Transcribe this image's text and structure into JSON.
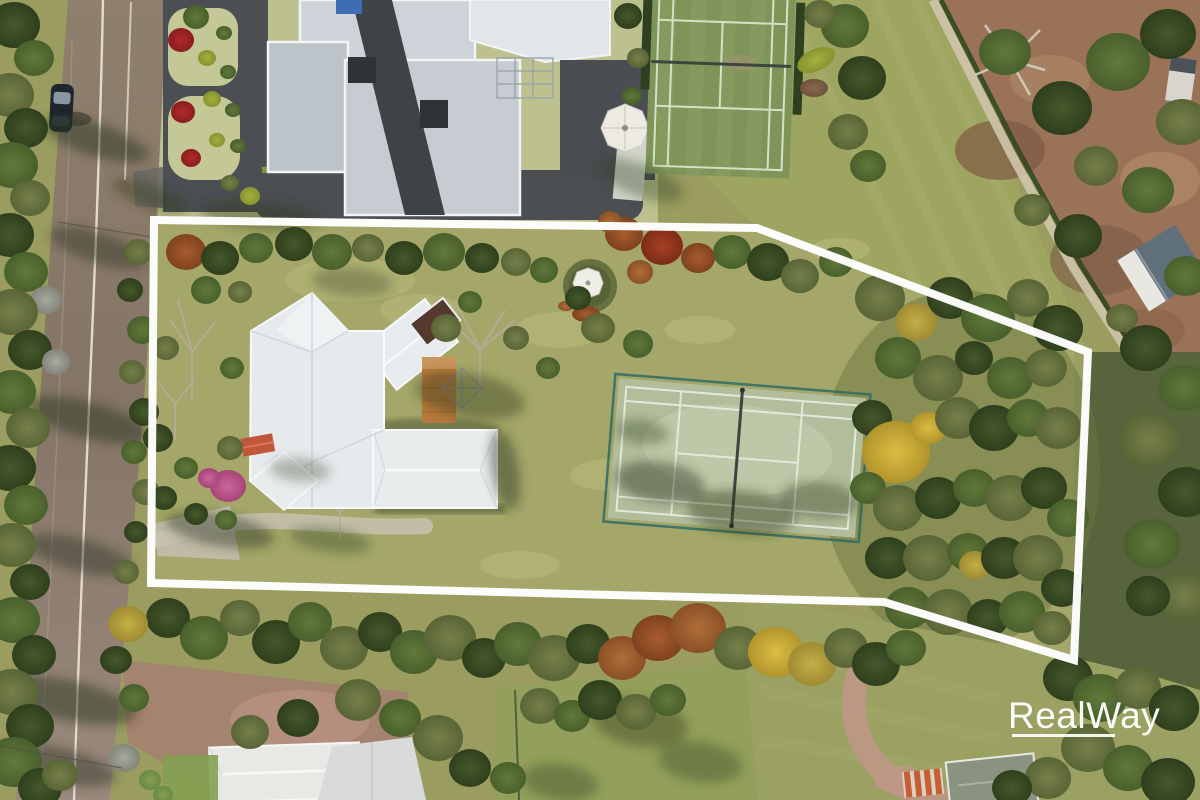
{
  "meta": {
    "kind": "aerial-drone-photo",
    "subject": "rural residential property with white boundary outline overlay"
  },
  "watermark": {
    "brand": "RealWay",
    "underline": true
  },
  "palette": {
    "base": "#9a9c60",
    "white": "#ffffff",
    "interior": "#a6a96b",
    "road1": "#8f7f6c",
    "road2": "#857567",
    "road3": "#9a897c",
    "roadLine": "#eae6da",
    "asphalt": "#4b4f53",
    "mansionLawn": "#bcc18f",
    "roofLight": "#cdd3d8",
    "roofMid": "#bcc3c9",
    "roofWhite": "#e2e6e9",
    "roofDark": "#3f4347",
    "houseRoof": "#e6eaec",
    "deck": "#b5793c",
    "awning": "#c0563a",
    "darkRoof": "#56392e",
    "topCourt": "#7e9459",
    "topCourtLine": "#d7e0c4",
    "paddock": "#9ea560",
    "dirt": "#997257",
    "track": "#cfc5ad",
    "hedgeLine": "#33471f",
    "court": "#b2bd9c",
    "courtLight": "#c3ccad",
    "courtLine": "#e3e9d9",
    "net": "#3c463e",
    "fence": "#2e6b66",
    "gazeboRoof": "#efeee7",
    "gazeboHedge": "#66713f",
    "field": "#9aa162",
    "lawn2": "#93a05b",
    "gravel": "#a4836f",
    "pinkPath": "#c09688",
    "sail": "#d8dbda",
    "roofBL": "#e8e9e5",
    "houseBR": "#8a9282",
    "shedOrange": "#c65f33",
    "barn": "#60707a",
    "shadow": "#2c381f"
  },
  "boundary": {
    "points": [
      [
        154,
        220
      ],
      [
        757,
        228
      ],
      [
        1088,
        352
      ],
      [
        1074,
        660
      ],
      [
        884,
        602
      ],
      [
        151,
        583
      ]
    ],
    "stroke_width": 8
  },
  "scene": {
    "regions": [
      "street",
      "neighbour-mansion",
      "neighbour-tennis-court",
      "paddock",
      "bare-dirt-yard",
      "property-lawn",
      "main-house",
      "timber-deck",
      "garden-gazebo",
      "private-tennis-court",
      "woodland",
      "rear-lawn",
      "neighbour-house-south",
      "gravel-driveway"
    ],
    "trees": [
      [
        14,
        25,
        26,
        "dg"
      ],
      [
        34,
        58,
        20,
        "mg"
      ],
      [
        10,
        95,
        24,
        "og"
      ],
      [
        26,
        128,
        22,
        "dg"
      ],
      [
        12,
        165,
        26,
        "mg"
      ],
      [
        30,
        198,
        20,
        "og"
      ],
      [
        10,
        235,
        24,
        "dg"
      ],
      [
        26,
        272,
        22,
        "mg"
      ],
      [
        46,
        300,
        16,
        "gray"
      ],
      [
        12,
        312,
        26,
        "og"
      ],
      [
        30,
        350,
        22,
        "dg"
      ],
      [
        56,
        362,
        14,
        "gray"
      ],
      [
        12,
        392,
        24,
        "mg"
      ],
      [
        28,
        428,
        22,
        "og"
      ],
      [
        10,
        468,
        26,
        "dg"
      ],
      [
        26,
        505,
        22,
        "mg"
      ],
      [
        12,
        545,
        24,
        "og"
      ],
      [
        30,
        582,
        20,
        "dg"
      ],
      [
        14,
        620,
        26,
        "mg"
      ],
      [
        34,
        655,
        22,
        "dg"
      ],
      [
        12,
        692,
        26,
        "og"
      ],
      [
        30,
        726,
        24,
        "dg"
      ],
      [
        14,
        762,
        28,
        "mg"
      ],
      [
        40,
        788,
        22,
        "dg"
      ],
      [
        60,
        775,
        18,
        "og"
      ],
      [
        138,
        252,
        14,
        "og"
      ],
      [
        130,
        290,
        13,
        "dg"
      ],
      [
        142,
        330,
        15,
        "mg"
      ],
      [
        132,
        372,
        13,
        "og"
      ],
      [
        144,
        412,
        15,
        "dg"
      ],
      [
        134,
        452,
        13,
        "mg"
      ],
      [
        146,
        492,
        14,
        "og"
      ],
      [
        136,
        532,
        12,
        "dg"
      ],
      [
        126,
        572,
        13,
        "og"
      ],
      [
        181,
        40,
        13,
        "red"
      ],
      [
        183,
        112,
        12,
        "red"
      ],
      [
        191,
        158,
        10,
        "red"
      ],
      [
        196,
        17,
        13,
        "mg"
      ],
      [
        207,
        58,
        9,
        "ch"
      ],
      [
        212,
        99,
        9,
        "ch"
      ],
      [
        217,
        140,
        8,
        "ch"
      ],
      [
        224,
        33,
        8,
        "mg"
      ],
      [
        228,
        72,
        8,
        "mg"
      ],
      [
        233,
        110,
        8,
        "mg"
      ],
      [
        238,
        146,
        8,
        "mg"
      ],
      [
        230,
        183,
        9,
        "og"
      ],
      [
        250,
        196,
        10,
        "ch"
      ],
      [
        628,
        16,
        14,
        "dg"
      ],
      [
        638,
        58,
        11,
        "og"
      ],
      [
        632,
        96,
        10,
        "mg"
      ],
      [
        845,
        26,
        24,
        "mg"
      ],
      [
        862,
        78,
        24,
        "dg"
      ],
      [
        848,
        132,
        20,
        "og"
      ],
      [
        868,
        166,
        18,
        "mg"
      ],
      [
        820,
        14,
        16,
        "og"
      ],
      [
        1005,
        52,
        26,
        "mg"
      ],
      [
        1062,
        108,
        30,
        "dg"
      ],
      [
        1118,
        62,
        32,
        "mg"
      ],
      [
        1168,
        34,
        28,
        "dg"
      ],
      [
        1182,
        122,
        26,
        "og"
      ],
      [
        1148,
        190,
        26,
        "mg"
      ],
      [
        1096,
        166,
        22,
        "og"
      ],
      [
        1078,
        236,
        24,
        "dg"
      ],
      [
        1186,
        276,
        22,
        "mg"
      ],
      [
        1032,
        210,
        18,
        "og"
      ],
      [
        1122,
        318,
        16,
        "og"
      ],
      [
        1146,
        348,
        26,
        "dg"
      ],
      [
        1184,
        388,
        26,
        "mg"
      ],
      [
        1150,
        440,
        30,
        "og"
      ],
      [
        1186,
        492,
        28,
        "dg"
      ],
      [
        1152,
        544,
        28,
        "mg"
      ],
      [
        1184,
        596,
        26,
        "og"
      ],
      [
        1148,
        596,
        22,
        "dg"
      ],
      [
        186,
        252,
        20,
        "rust"
      ],
      [
        220,
        258,
        19,
        "dg"
      ],
      [
        256,
        248,
        17,
        "mg"
      ],
      [
        294,
        244,
        19,
        "dg"
      ],
      [
        332,
        252,
        20,
        "mg"
      ],
      [
        368,
        248,
        16,
        "og"
      ],
      [
        404,
        258,
        19,
        "dg"
      ],
      [
        444,
        252,
        21,
        "mg"
      ],
      [
        482,
        258,
        17,
        "dg"
      ],
      [
        516,
        262,
        15,
        "og"
      ],
      [
        544,
        270,
        14,
        "mg"
      ],
      [
        206,
        290,
        15,
        "mg"
      ],
      [
        240,
        292,
        12,
        "og"
      ],
      [
        624,
        234,
        19,
        "rust"
      ],
      [
        662,
        246,
        21,
        "red2"
      ],
      [
        698,
        258,
        17,
        "rust"
      ],
      [
        640,
        272,
        13,
        "copper"
      ],
      [
        610,
        222,
        12,
        "copper"
      ],
      [
        732,
        252,
        19,
        "mg"
      ],
      [
        768,
        262,
        21,
        "dg"
      ],
      [
        800,
        276,
        19,
        "og"
      ],
      [
        836,
        262,
        17,
        "mg"
      ],
      [
        166,
        348,
        13,
        "og"
      ],
      [
        232,
        368,
        12,
        "mg"
      ],
      [
        158,
        438,
        15,
        "dg"
      ],
      [
        230,
        448,
        13,
        "og"
      ],
      [
        186,
        468,
        12,
        "mg"
      ],
      [
        164,
        498,
        13,
        "dg"
      ],
      [
        196,
        514,
        12,
        "dg"
      ],
      [
        226,
        520,
        11,
        "mg"
      ],
      [
        228,
        486,
        18,
        "pink"
      ],
      [
        209,
        478,
        11,
        "pink"
      ],
      [
        446,
        328,
        15,
        "og"
      ],
      [
        516,
        338,
        13,
        "og"
      ],
      [
        548,
        368,
        12,
        "mg"
      ],
      [
        598,
        328,
        17,
        "og"
      ],
      [
        638,
        344,
        15,
        "mg"
      ],
      [
        578,
        298,
        13,
        "dg"
      ],
      [
        470,
        302,
        12,
        "mg"
      ],
      [
        880,
        298,
        25,
        "og"
      ],
      [
        916,
        322,
        21,
        "gold2"
      ],
      [
        950,
        298,
        23,
        "dg"
      ],
      [
        988,
        318,
        27,
        "mg"
      ],
      [
        1028,
        298,
        21,
        "og"
      ],
      [
        1058,
        328,
        25,
        "dg"
      ],
      [
        898,
        358,
        23,
        "mg"
      ],
      [
        938,
        378,
        25,
        "og"
      ],
      [
        974,
        358,
        19,
        "dg"
      ],
      [
        1010,
        378,
        23,
        "mg"
      ],
      [
        1046,
        368,
        21,
        "og"
      ],
      [
        872,
        418,
        20,
        "dg"
      ],
      [
        896,
        452,
        34,
        "gold"
      ],
      [
        928,
        428,
        18,
        "gold"
      ],
      [
        958,
        418,
        23,
        "og"
      ],
      [
        994,
        428,
        25,
        "dg"
      ],
      [
        1028,
        418,
        21,
        "mg"
      ],
      [
        1058,
        428,
        23,
        "og"
      ],
      [
        868,
        488,
        18,
        "mg"
      ],
      [
        898,
        508,
        25,
        "og"
      ],
      [
        938,
        498,
        23,
        "dg"
      ],
      [
        974,
        488,
        21,
        "mg"
      ],
      [
        1010,
        498,
        25,
        "og"
      ],
      [
        1044,
        488,
        23,
        "dg"
      ],
      [
        1068,
        518,
        21,
        "mg"
      ],
      [
        888,
        558,
        23,
        "dg"
      ],
      [
        928,
        558,
        25,
        "og"
      ],
      [
        968,
        552,
        21,
        "mg"
      ],
      [
        975,
        565,
        16,
        "gold2"
      ],
      [
        1004,
        558,
        23,
        "dg"
      ],
      [
        1038,
        558,
        25,
        "og"
      ],
      [
        1062,
        588,
        21,
        "dg"
      ],
      [
        908,
        608,
        23,
        "mg"
      ],
      [
        948,
        612,
        25,
        "og"
      ],
      [
        988,
        618,
        21,
        "dg"
      ],
      [
        1022,
        612,
        23,
        "mg"
      ],
      [
        1052,
        628,
        19,
        "og"
      ],
      [
        168,
        618,
        22,
        "dg"
      ],
      [
        204,
        638,
        24,
        "mg"
      ],
      [
        240,
        618,
        20,
        "og"
      ],
      [
        276,
        642,
        24,
        "dg"
      ],
      [
        310,
        622,
        22,
        "mg"
      ],
      [
        344,
        648,
        24,
        "og"
      ],
      [
        380,
        632,
        22,
        "dg"
      ],
      [
        414,
        652,
        24,
        "mg"
      ],
      [
        450,
        638,
        26,
        "og"
      ],
      [
        484,
        658,
        22,
        "dg"
      ],
      [
        518,
        644,
        24,
        "mg"
      ],
      [
        554,
        658,
        26,
        "og"
      ],
      [
        588,
        644,
        22,
        "dg"
      ],
      [
        622,
        658,
        24,
        "copper"
      ],
      [
        658,
        638,
        26,
        "rust"
      ],
      [
        698,
        628,
        28,
        "copper"
      ],
      [
        738,
        648,
        24,
        "og"
      ],
      [
        776,
        652,
        28,
        "gold"
      ],
      [
        812,
        664,
        24,
        "gold2"
      ],
      [
        846,
        648,
        22,
        "og"
      ],
      [
        876,
        664,
        24,
        "dg"
      ],
      [
        906,
        648,
        20,
        "mg"
      ],
      [
        128,
        624,
        20,
        "gold2"
      ],
      [
        116,
        660,
        16,
        "dg"
      ],
      [
        134,
        698,
        15,
        "mg"
      ],
      [
        124,
        758,
        16,
        "gray"
      ],
      [
        150,
        780,
        11,
        "bg"
      ],
      [
        163,
        795,
        10,
        "bg"
      ],
      [
        250,
        732,
        19,
        "og"
      ],
      [
        298,
        718,
        21,
        "dg"
      ],
      [
        358,
        700,
        23,
        "og"
      ],
      [
        400,
        718,
        21,
        "mg"
      ],
      [
        438,
        738,
        25,
        "og"
      ],
      [
        470,
        768,
        21,
        "dg"
      ],
      [
        508,
        778,
        18,
        "mg"
      ],
      [
        540,
        706,
        20,
        "og"
      ],
      [
        572,
        716,
        18,
        "mg"
      ],
      [
        600,
        700,
        22,
        "dg"
      ],
      [
        636,
        712,
        20,
        "og"
      ],
      [
        668,
        700,
        18,
        "mg"
      ],
      [
        1068,
        678,
        25,
        "dg"
      ],
      [
        1100,
        698,
        27,
        "mg"
      ],
      [
        1138,
        688,
        23,
        "og"
      ],
      [
        1174,
        708,
        25,
        "dg"
      ],
      [
        1088,
        748,
        27,
        "og"
      ],
      [
        1128,
        768,
        25,
        "mg"
      ],
      [
        1168,
        782,
        27,
        "dg"
      ],
      [
        1048,
        778,
        23,
        "og"
      ],
      [
        1012,
        788,
        20,
        "dg"
      ]
    ],
    "shadows": [
      [
        96,
        140,
        55,
        16,
        18,
        0.5
      ],
      [
        98,
        248,
        50,
        15,
        18,
        0.45
      ],
      [
        88,
        420,
        62,
        18,
        15,
        0.5
      ],
      [
        80,
        555,
        55,
        16,
        15,
        0.45
      ],
      [
        66,
        700,
        72,
        20,
        12,
        0.5
      ],
      [
        55,
        765,
        62,
        18,
        12,
        0.45
      ],
      [
        150,
        196,
        40,
        12,
        20,
        0.4
      ],
      [
        660,
        482,
        45,
        20,
        8,
        0.45
      ],
      [
        742,
        512,
        55,
        22,
        6,
        0.42
      ],
      [
        820,
        500,
        40,
        18,
        6,
        0.38
      ],
      [
        642,
        432,
        26,
        12,
        8,
        0.35
      ],
      [
        640,
        722,
        48,
        24,
        10,
        0.4
      ],
      [
        700,
        762,
        42,
        20,
        8,
        0.35
      ],
      [
        560,
        782,
        38,
        18,
        8,
        0.35
      ],
      [
        470,
        396,
        55,
        22,
        10,
        0.4
      ],
      [
        352,
        282,
        40,
        14,
        5,
        0.3
      ],
      [
        300,
        470,
        30,
        12,
        5,
        0.3
      ],
      [
        505,
        470,
        40,
        14,
        80,
        0.45
      ],
      [
        640,
        180,
        45,
        16,
        20,
        0.35
      ],
      [
        260,
        215,
        60,
        14,
        5,
        0.4
      ],
      [
        220,
        530,
        55,
        16,
        10,
        0.45
      ],
      [
        330,
        540,
        40,
        12,
        8,
        0.35
      ]
    ]
  }
}
